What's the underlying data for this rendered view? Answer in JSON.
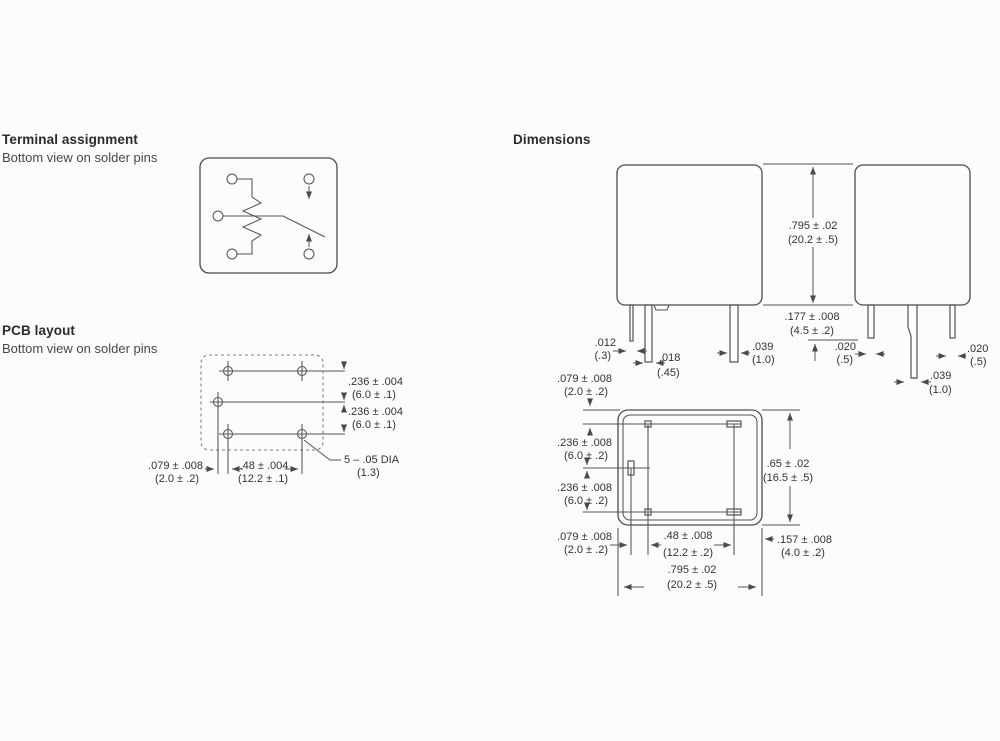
{
  "page": {
    "background": "#fcfcfc",
    "line_color": "#4d4d4d",
    "text_color": "#333333"
  },
  "sections": {
    "terminal": {
      "heading": "Terminal assignment",
      "subheading": "Bottom view on solder pins"
    },
    "pcb": {
      "heading": "PCB layout",
      "subheading": "Bottom view on solder pins",
      "dims": {
        "row1_in": ".236 ± .004",
        "row1_mm": "(6.0 ± .1)",
        "row2_in": ".236 ± .004",
        "row2_mm": "(6.0 ± .1)",
        "offset_in": ".079 ± .008",
        "offset_mm": "(2.0 ± .2)",
        "span_in": ".48 ± .004",
        "span_mm": "(12.2 ± .1)",
        "holes_in": "5 – .05 DIA",
        "holes_mm": "(1.3)"
      }
    },
    "dimensions": {
      "heading": "Dimensions",
      "height_in": ".795 ± .02",
      "height_mm": "(20.2 ± .5)",
      "pin_length_in": ".177 ± .008",
      "pin_length_mm": "(4.5 ± .2)",
      "front": {
        "pin1_in": ".012",
        "pin1_mm": "(.3)",
        "pin2_in": ".018",
        "pin2_mm": "(.45)",
        "pin3_in": ".039",
        "pin3_mm": "(1.0)"
      },
      "side": {
        "pin1_in": ".020",
        "pin1_mm": "(.5)",
        "pin2_in": ".039",
        "pin2_mm": "(1.0)",
        "pin3_in": ".020",
        "pin3_mm": "(.5)"
      },
      "bottom": {
        "top_offset_in": ".079 ± .008",
        "top_offset_mm": "(2.0 ± .2)",
        "row1_in": ".236 ± .008",
        "row1_mm": "(6.0 ± .2)",
        "row2_in": ".236 ± .008",
        "row2_mm": "(6.0 ± .2)",
        "depth_in": ".65 ± .02",
        "depth_mm": "(16.5 ± .5)",
        "left_offset_in": ".079 ± .008",
        "left_offset_mm": "(2.0 ± .2)",
        "span_in": ".48 ± .008",
        "span_mm": "(12.2 ± .2)",
        "right_offset_in": ".157 ± .008",
        "right_offset_mm": "(4.0 ± .2)",
        "width_in": ".795 ± .02",
        "width_mm": "(20.2 ± .5)"
      }
    }
  }
}
